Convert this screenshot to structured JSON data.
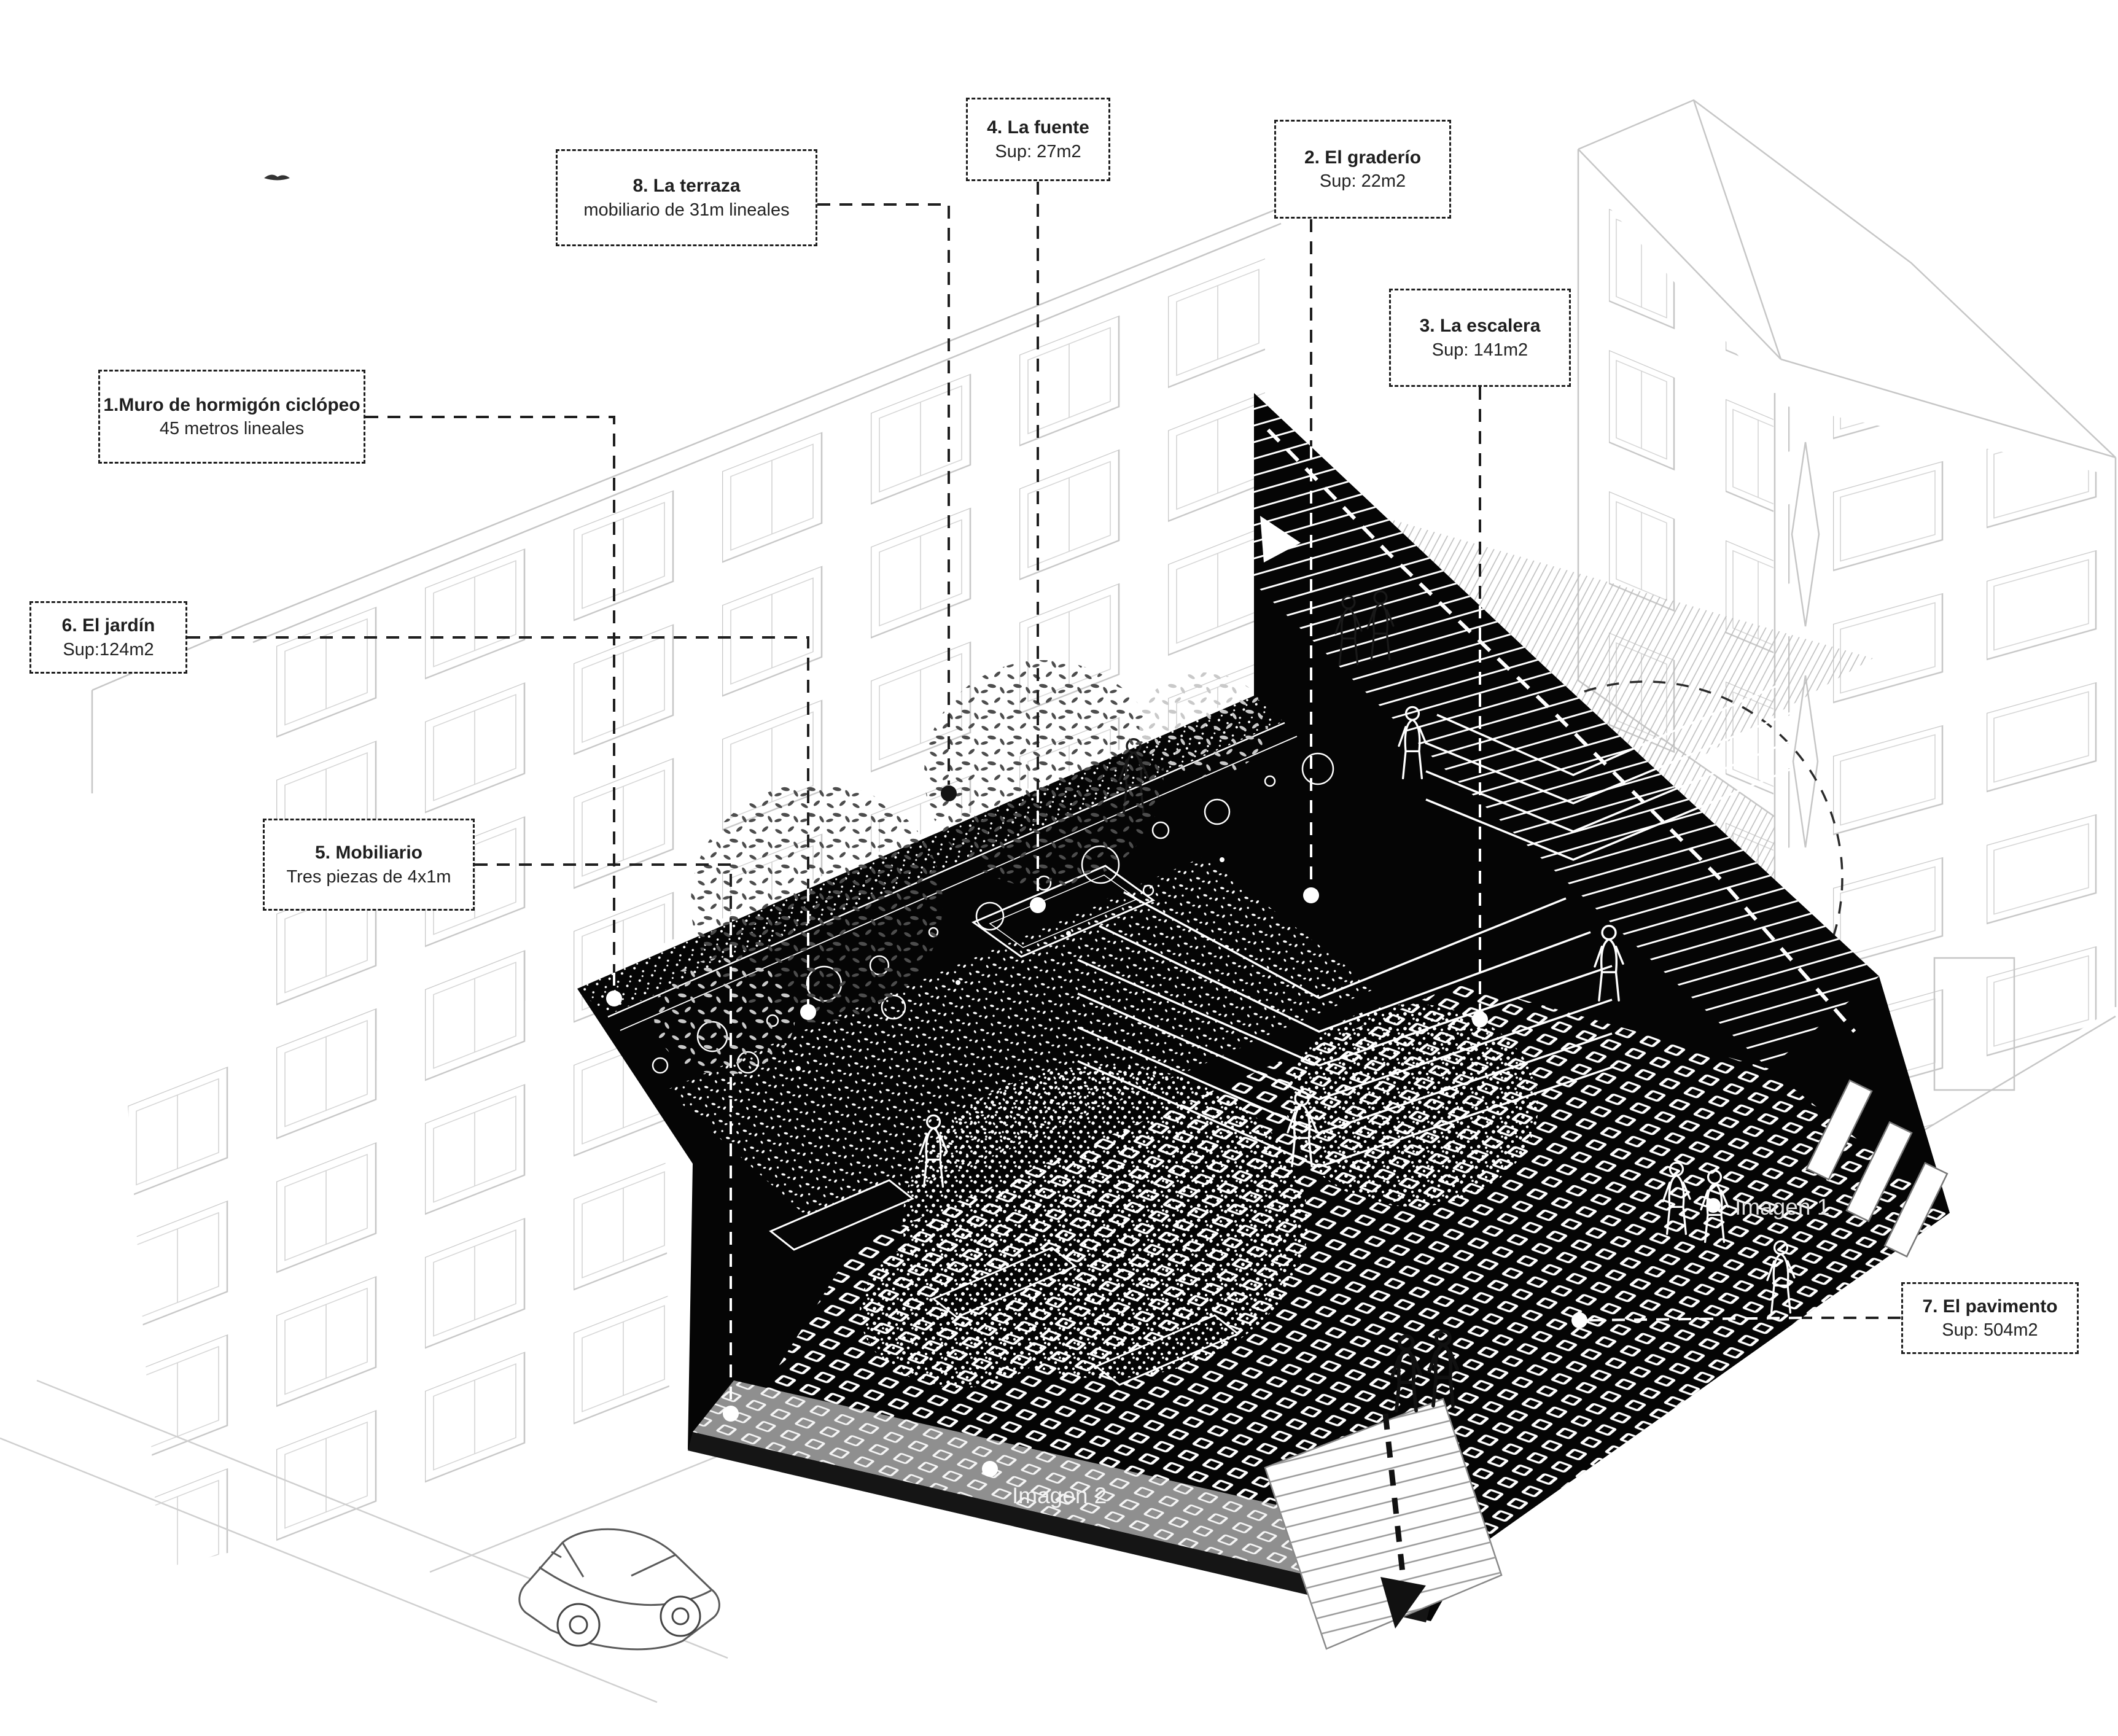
{
  "page": {
    "type": "architectural axonometric diagram",
    "language": "es",
    "background": "#ffffff"
  },
  "annotations": [
    {
      "number": "1",
      "title": "1.Muro de hormigón ciclópeo",
      "subtitle": "45 metros lineales"
    },
    {
      "number": "2",
      "title": "2. El graderío",
      "subtitle": "Sup: 22m2"
    },
    {
      "number": "3",
      "title": "3. La escalera",
      "subtitle": "Sup: 141m2"
    },
    {
      "number": "4",
      "title": "4. La fuente",
      "subtitle": "Sup: 27m2"
    },
    {
      "number": "5",
      "title": "5. Mobiliario",
      "subtitle": "Tres piezas de 4x1m"
    },
    {
      "number": "6",
      "title": "6. El jardín",
      "subtitle": "Sup:124m2"
    },
    {
      "number": "7",
      "title": "7. El pavimento",
      "subtitle": "Sup: 504m2"
    },
    {
      "number": "8",
      "title": "8. La terraza",
      "subtitle": "mobiliario de 31m lineales"
    }
  ],
  "drawing_labels": {
    "imagen1": "Imagen 1",
    "imagen2": "Imagen 2"
  },
  "colors": {
    "ink": "#1f1f1f",
    "black_fill": "#050505",
    "faint_line": "#c6c6c6",
    "paper": "#ffffff"
  }
}
